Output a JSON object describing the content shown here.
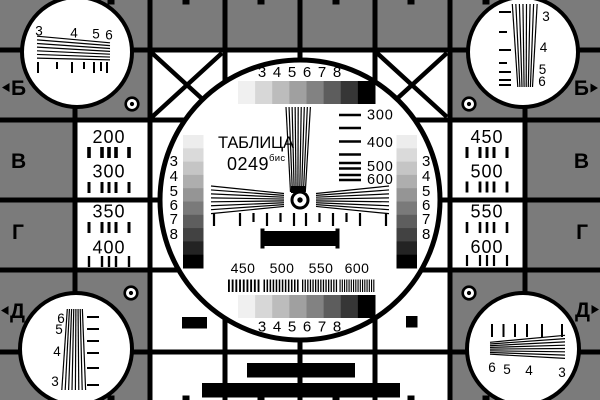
{
  "card": {
    "title": "ТАБЛИЦА",
    "model": "0249",
    "model_super": "бис"
  },
  "colors": {
    "background_gray": "#7b7b7b",
    "foreground_black": "#000000",
    "panel_white": "#ffffff"
  },
  "center": {
    "top_steps_labels": [
      "3",
      "4",
      "5",
      "6",
      "7",
      "8"
    ],
    "bottom_steps_labels": [
      "3",
      "4",
      "5",
      "6",
      "7",
      "8"
    ],
    "vwedge_labels": [
      "300",
      "400",
      "500",
      "600"
    ],
    "freq_labels": [
      "450",
      "500",
      "550",
      "600"
    ],
    "left_stair_labels": [
      "3",
      "4",
      "5",
      "6",
      "7",
      "8"
    ],
    "right_stair_labels": [
      "3",
      "4",
      "5",
      "6",
      "7",
      "8"
    ]
  },
  "left_column_values": [
    "200",
    "300",
    "350",
    "400"
  ],
  "right_column_values": [
    "450",
    "500",
    "550",
    "600"
  ],
  "row_letters_left": [
    "Б",
    "В",
    "Г",
    "Д"
  ],
  "row_letters_right": [
    "Б",
    "В",
    "Г",
    "Д"
  ],
  "corner_circles": {
    "top_left_labels": [
      "3",
      "4",
      "5",
      "6"
    ],
    "top_right_labels": [
      "3",
      "4",
      "5",
      "6"
    ],
    "bottom_left_labels": [
      "6",
      "5",
      "4",
      "3"
    ],
    "bottom_right_labels": [
      "6",
      "5",
      "4",
      "3"
    ]
  },
  "grayscale_steps": [
    "#f0f0f0",
    "#d7d7d7",
    "#bcbcbc",
    "#a0a0a0",
    "#828282",
    "#5d5d5d",
    "#363636",
    "#000000"
  ],
  "staircase_steps": [
    "#ededed",
    "#dadada",
    "#c5c5c5",
    "#aeaeae",
    "#959595",
    "#7a7a7a",
    "#5e5e5e",
    "#424242",
    "#232323",
    "#000000"
  ]
}
